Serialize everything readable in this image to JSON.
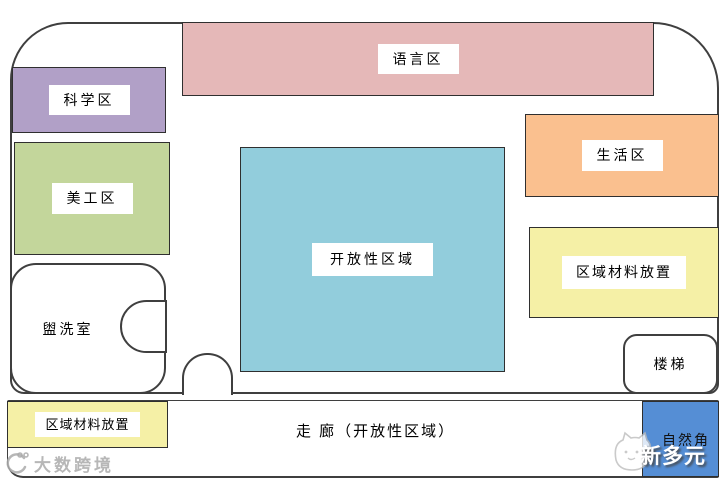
{
  "diagram": {
    "wall_color": "#3f3f3f",
    "areas": {
      "language": {
        "label": "语言区",
        "color": "#e5b8b8"
      },
      "science": {
        "label": "科学区",
        "color": "#b1a0c7"
      },
      "art": {
        "label": "美工区",
        "color": "#c3d69b"
      },
      "open_area": {
        "label": "开放性区域",
        "color": "#92cddc"
      },
      "living": {
        "label": "生活区",
        "color": "#fac08f"
      },
      "materials_right": {
        "label": "区域材料放置",
        "color": "#f5f0a6"
      },
      "materials_left": {
        "label": "区域材料放置",
        "color": "#f5f0a6"
      },
      "washroom": {
        "label": "盥洗室",
        "color": "#ffffff"
      },
      "stairs": {
        "label": "楼梯",
        "color": "#ffffff"
      },
      "corridor": {
        "label": "走 廊（开放性区域）",
        "color": "#ffffff"
      },
      "nature_corner": {
        "label": "自然角",
        "color": "#558ed5"
      }
    }
  },
  "watermarks": {
    "bottom_left_brand": "大数跨境",
    "bottom_right_brand": "新多元"
  }
}
